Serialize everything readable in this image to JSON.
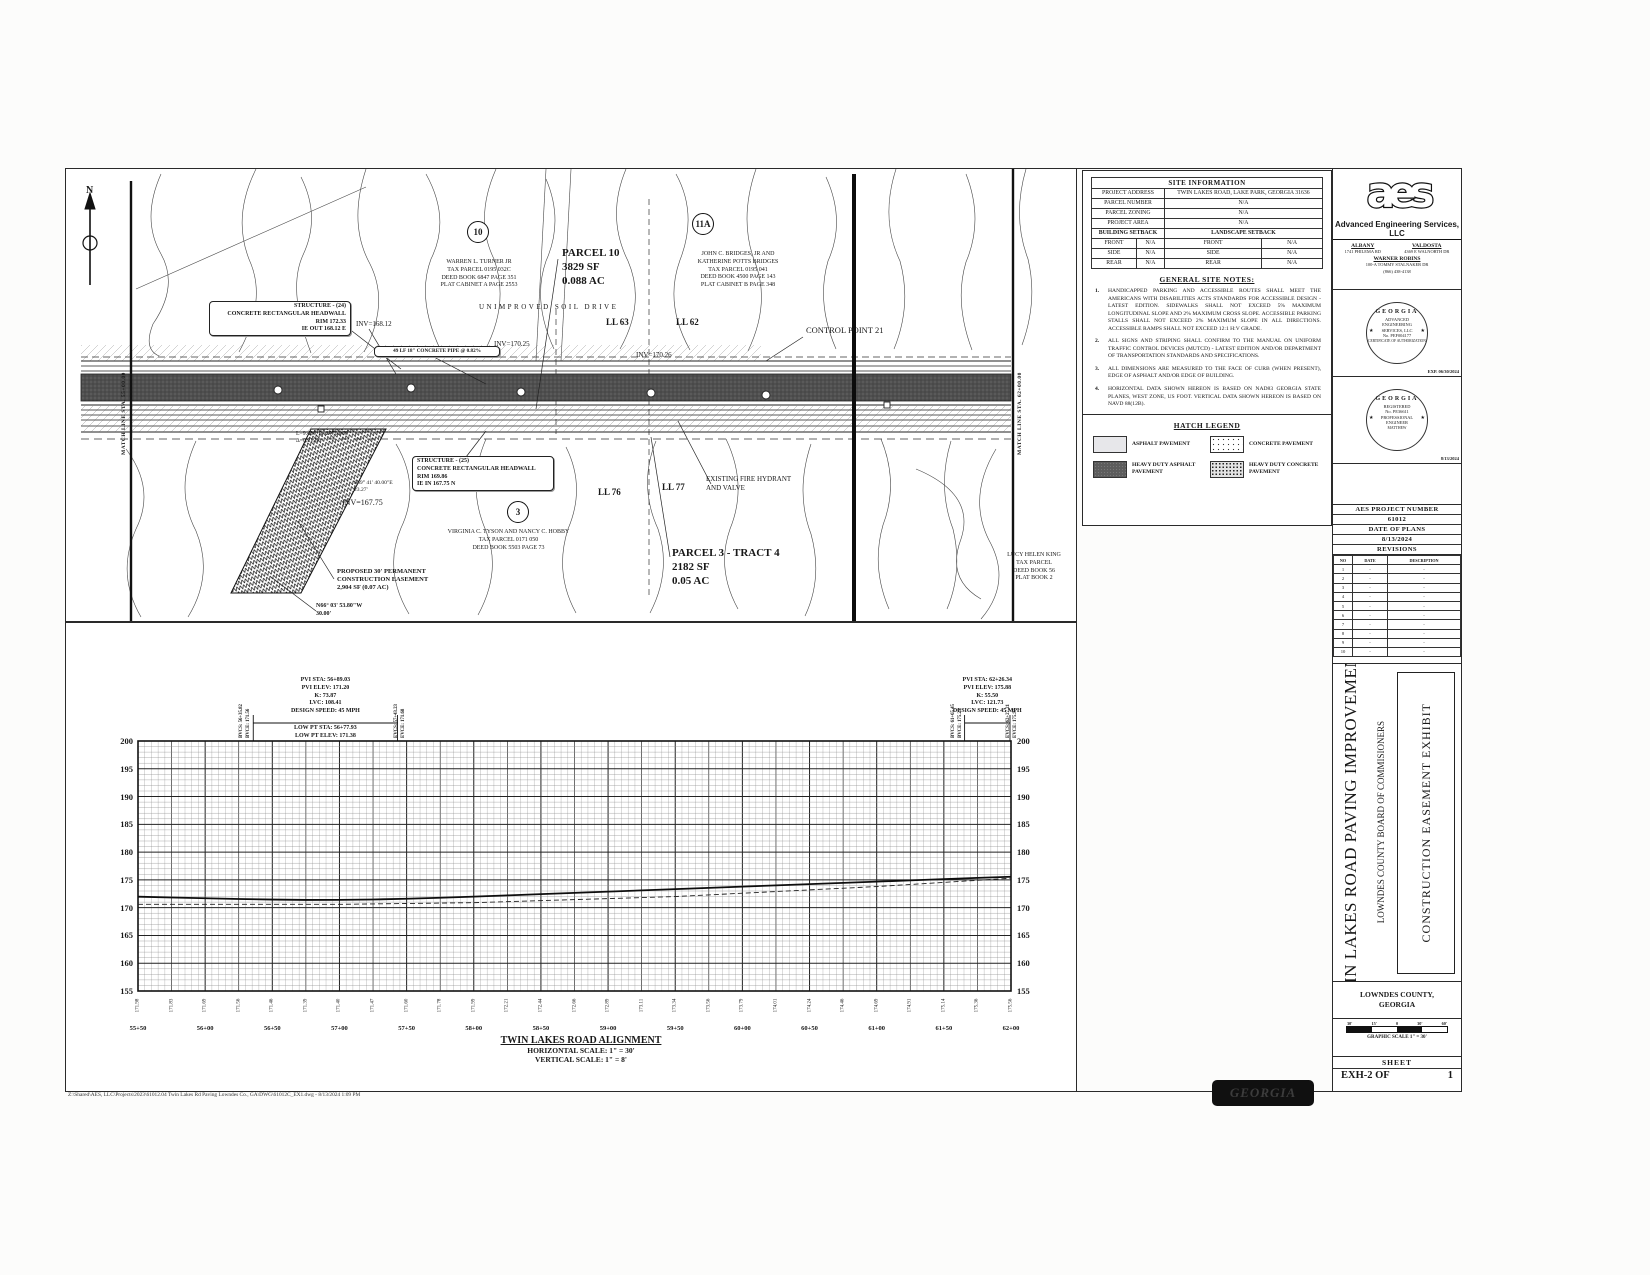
{
  "colors": {
    "ink": "#1a1a1a",
    "paper": "#ffffff",
    "heavy_asphalt_band": "#4f4f4f"
  },
  "plan": {
    "north_label": "N",
    "match_line_left": "MATCH LINE STA. 55+00.00",
    "match_line_right": "MATCH LINE STA. 62+00.00",
    "bubble_10": "10",
    "bubble_11a": "11A",
    "bubble_3": "3",
    "owner_10": [
      "WARREN L. TURNER JR",
      "TAX PARCEL 0195 032C",
      "DEED BOOK 6847 PAGE 351",
      "PLAT CABINET A PAGE 2553"
    ],
    "parcel_10": [
      "PARCEL 10",
      "3829 SF",
      "0.088 AC"
    ],
    "owner_11a": [
      "JOHN C. BRIDGES, JR AND",
      "KATHERINE POTTS BRIDGES",
      "TAX PARCEL 0195 041",
      "DEED BOOK 4500 PAGE 143",
      "PLAT CABINET B PAGE 348"
    ],
    "owner_3": [
      "VIRGINIA C. TYSON AND NANCY C. HOBBY",
      "TAX PARCEL 0171 050",
      "DEED BOOK 5503 PAGE 73"
    ],
    "owner_king": [
      "LUCY HELEN KING",
      "TAX PARCEL",
      "DEED BOOK 56",
      "PLAT BOOK 2"
    ],
    "parcel_3": [
      "PARCEL 3 - TRACT 4",
      "2182 SF",
      "0.05 AC"
    ],
    "drive_label": "UNIMPROVED SOIL DRIVE",
    "lot_lines": {
      "ll62": "LL 62",
      "ll63": "LL 63",
      "ll76": "LL 76",
      "ll77": "LL 77"
    },
    "control_point": "CONTROL POINT 21",
    "structure_24": [
      "STRUCTURE - (24)",
      "CONCRETE RECTANGULAR HEADWALL",
      "RIM 172.33",
      "IE OUT 168.12 E"
    ],
    "structure_25": [
      "STRUCTURE - (25)",
      "CONCRETE RECTANGULAR HEADWALL",
      "RIM 169.86",
      "IE IN 167.75 N"
    ],
    "pipe_callout": "49 LF 18\" CONCRETE PIPE @ 0.82%",
    "inv_168": "INV=168.12",
    "inv_170a": "INV=170.25",
    "inv_170b": "INV=170.26",
    "inv_167": "INV=167.75",
    "bearing_s69": [
      "S69° 41' 40.00\"E",
      "23.27'"
    ],
    "bearing_n66": [
      "N66° 03' 53.80\"W",
      "30.00'"
    ],
    "curve_data": [
      "L=9.480, R=2470.000",
      "Δ=0.2199"
    ],
    "easement": [
      "PROPOSED 30' PERMANENT",
      "CONSTRUCTION EASEMENT",
      "2,904 SF (0.07 AC)"
    ],
    "hydrant": [
      "EXISTING FIRE HYDRANT",
      "AND VALVE"
    ]
  },
  "site_information": {
    "title": "SITE INFORMATION",
    "rows": [
      {
        "l": "PROJECT ADDRESS",
        "v": "TWIN LAKES ROAD, LAKE PARK, GEORGIA 31636"
      },
      {
        "l": "PARCEL NUMBER",
        "v": "N/A"
      },
      {
        "l": "PARCEL ZONING",
        "v": "N/A"
      },
      {
        "l": "PROJECT AREA",
        "v": "N/A"
      }
    ],
    "setback_left": "BUILDING SETBACK",
    "setback_right": "LANDSCAPE SETBACK",
    "setback_rows": [
      [
        "FRONT",
        "N/A",
        "FRONT",
        "N/A"
      ],
      [
        "SIDE",
        "N/A",
        "SIDE",
        "N/A"
      ],
      [
        "REAR",
        "N/A",
        "REAR",
        "N/A"
      ]
    ]
  },
  "general_site_notes": {
    "title": "GENERAL SITE NOTES:",
    "items": [
      {
        "n": "1.",
        "text": "HANDICAPPED PARKING AND ACCESSIBLE ROUTES SHALL MEET THE AMERICANS WITH DISABILITIES ACTS STANDARDS FOR ACCESSIBLE DESIGN - LATEST EDITION. SIDEWALKS SHALL NOT EXCEED 5% MAXIMUM LONGITUDINAL SLOPE AND 2% MAXIMUM CROSS SLOPE. ACCESSIBLE PARKING STALLS SHALL NOT EXCEED 2% MAXIMUM SLOPE IN ALL DIRECTIONS. ACCESSIBLE RAMPS SHALL NOT EXCEED 12:1 H:V GRADE."
      },
      {
        "n": "2.",
        "text": "ALL SIGNS AND STRIPING SHALL CONFIRM TO THE MANUAL ON UNIFORM TRAFFIC CONTROL DEVICES (MUTCD) - LATEST EDITION AND/OR DEPARTMENT OF TRANSPORTATION STANDARDS AND SPECIFICATIONS."
      },
      {
        "n": "3.",
        "text": "ALL DIMENSIONS ARE MEASURED TO THE FACE OF CURB (WHEN PRESENT), EDGE OF ASPHALT AND/OR EDGE OF BUILDING."
      },
      {
        "n": "4.",
        "text": "HORIZONTAL DATA SHOWN HEREON IS BASED ON NAD83 GEORGIA STATE PLANES, WEST ZONE, US FOOT. VERTICAL DATA SHOWN HEREON IS BASED ON NAVD 88(12B)."
      }
    ]
  },
  "hatch_legend": {
    "title": "HATCH LEGEND",
    "items": [
      {
        "label": "ASPHALT PAVEMENT"
      },
      {
        "label": "CONCRETE PAVEMENT"
      },
      {
        "label": "HEAVY DUTY ASPHALT PAVEMENT"
      },
      {
        "label": "HEAVY DUTY CONCRETE PAVEMENT"
      }
    ]
  },
  "firm": {
    "logo": "aes",
    "name": "Advanced Engineering Services, LLC",
    "offices": [
      {
        "city": "ALBANY",
        "addr": "1741 PHILEMA RD"
      },
      {
        "city": "VALDOSTA",
        "addr": "4369 E WALNORTH DR"
      }
    ],
    "office3": {
      "city": "WARNER ROBINS",
      "addr": "100-A TOMMY STALNAKER DR"
    },
    "phone": "(866) 438-4138"
  },
  "stamps": {
    "s1": {
      "state": "GEORGIA",
      "l1": "ADVANCED",
      "l2": "ENGINEERING",
      "l3": "SERVICES, LLC",
      "l4": "No. PEF004177",
      "ring": "CERTIFICATE OF AUTHORIZATION",
      "exp": "EXP. 06/30/2024"
    },
    "s2": {
      "state": "GEORGIA",
      "ring_top": "REGISTERED",
      "no": "No. PE36611",
      "prof": "PROFESSIONAL",
      "ring_bottom": "ENGINEER",
      "name": "MATTHEW"
    },
    "date": "8/13/2024"
  },
  "project_block": {
    "number_label": "AES PROJECT NUMBER",
    "number": "61012",
    "date_label": "DATE OF PLANS",
    "date": "8/13/2024",
    "revisions_label": "REVISIONS",
    "rev_headers": [
      "NO",
      "DATE",
      "DESCRIPTION"
    ],
    "rev_rows": [
      [
        "1",
        "-",
        "-"
      ],
      [
        "2",
        "-",
        "-"
      ],
      [
        "3",
        "-",
        "-"
      ],
      [
        "4",
        "-",
        "-"
      ],
      [
        "5",
        "-",
        "-"
      ],
      [
        "6",
        "-",
        "-"
      ],
      [
        "7",
        "-",
        "-"
      ],
      [
        "8",
        "-",
        "-"
      ],
      [
        "9",
        "-",
        "-"
      ],
      [
        "10",
        "-",
        "-"
      ]
    ]
  },
  "title_block": {
    "project_title": "TWIN LAKES ROAD PAVING IMPROVEMENTS",
    "client": "LOWNDES COUNTY BOARD OF COMMISIONERS",
    "exhibit_title": "CONSTRUCTION EASEMENT EXHIBIT",
    "county": [
      "LOWNDES COUNTY,",
      "GEORGIA"
    ],
    "scale_ticks": [
      "30'",
      "15'",
      "0",
      "30'",
      "60'"
    ],
    "scale_caption": "GRAPHIC SCALE 1\" = 30'",
    "sheet_label": "SHEET",
    "sheet_number": "EXH-2 OF",
    "sheet_total": "1"
  },
  "profile": {
    "title": "TWIN LAKES ROAD ALIGNMENT",
    "horizontal_scale": "HORIZONTAL SCALE: 1\" = 30'",
    "vertical_scale": "VERTICAL SCALE: 1\" = 8'",
    "elev_ticks": [
      "200",
      "195",
      "190",
      "185",
      "180",
      "175",
      "170",
      "165",
      "160",
      "155"
    ],
    "stations": [
      "55+50",
      "56+00",
      "56+50",
      "57+00",
      "57+50",
      "58+00",
      "58+50",
      "59+00",
      "59+50",
      "60+00",
      "60+50",
      "61+00",
      "61+50",
      "62+00"
    ],
    "ground_values": [
      "171.98",
      "171.83",
      "171.69",
      "171.56",
      "171.46",
      "171.39",
      "171.40",
      "171.47",
      "171.60",
      "171.78",
      "171.99",
      "172.21",
      "172.44",
      "172.66",
      "172.89",
      "173.11",
      "173.34",
      "173.56",
      "173.79",
      "174.01",
      "174.24",
      "174.46",
      "174.69",
      "174.91",
      "175.14",
      "175.36",
      "175.56"
    ],
    "curves": [
      {
        "pvi": [
          "PVI STA: 56+89.03",
          "PVI ELEV: 171.20",
          "K: 73.87",
          "LVC: 108.41",
          "DESIGN SPEED: 45 MPH"
        ],
        "low": [
          "LOW PT STA: 56+77.93",
          "LOW PT ELEV: 171.38"
        ],
        "bvc_ft": 5635.82,
        "evc_ft": 5743.23,
        "bvc_labels": [
          "BVCS: 56+35.82",
          "BVCE: 171.56"
        ],
        "evc_labels": [
          "EVCS: 57+43.23",
          "EVCE: 171.68"
        ]
      },
      {
        "pvi": [
          "PVI STA: 62+26.34",
          "PVI ELEV: 175.88",
          "K: 55.50",
          "LVC: 121.73",
          "DESIGN SPEED: 45 MPH"
        ],
        "low": [],
        "bvc_ft": 6165.45,
        "evc_ft": 6227.21,
        "bvc_labels": [
          "BVCS: 61+65.45",
          "BVCE: 175.25"
        ],
        "evc_labels": [
          "EVCS: 62+27.21",
          "EVCE: 175.97"
        ]
      }
    ]
  },
  "chart_data": {
    "type": "line",
    "title": "TWIN LAKES ROAD ALIGNMENT",
    "x_stations": [
      "55+50",
      "56+00",
      "56+50",
      "57+00",
      "57+50",
      "58+00",
      "58+50",
      "59+00",
      "59+50",
      "60+00",
      "60+50",
      "61+00",
      "61+50",
      "62+00"
    ],
    "x_start_ft": 5550,
    "x_step_ft": 25,
    "ylim": [
      155,
      200
    ],
    "series": [
      {
        "name": "proposed grade",
        "values": [
          171.98,
          171.83,
          171.69,
          171.56,
          171.46,
          171.39,
          171.4,
          171.47,
          171.6,
          171.78,
          171.99,
          172.21,
          172.44,
          172.66,
          172.89,
          173.11,
          173.34,
          173.56,
          173.79,
          174.01,
          174.24,
          174.46,
          174.69,
          174.91,
          175.14,
          175.36,
          175.56
        ]
      },
      {
        "name": "existing ground",
        "x_ft": [
          5550,
          5700,
          5800,
          5950,
          6100,
          6200
        ],
        "values": [
          170.6,
          170.6,
          170.9,
          172.0,
          173.8,
          175.3
        ]
      }
    ]
  },
  "georgia_stamp": "GEORGIA",
  "footer": {
    "path": "Z:\\Shared\\AES, LLC\\Projects\\2023\\61012.04 Twin Lakes Rd Paving Lowndes Co., GA\\DWG\\61012C_EX1.dwg - 8/13/2024 1:09 PM"
  }
}
